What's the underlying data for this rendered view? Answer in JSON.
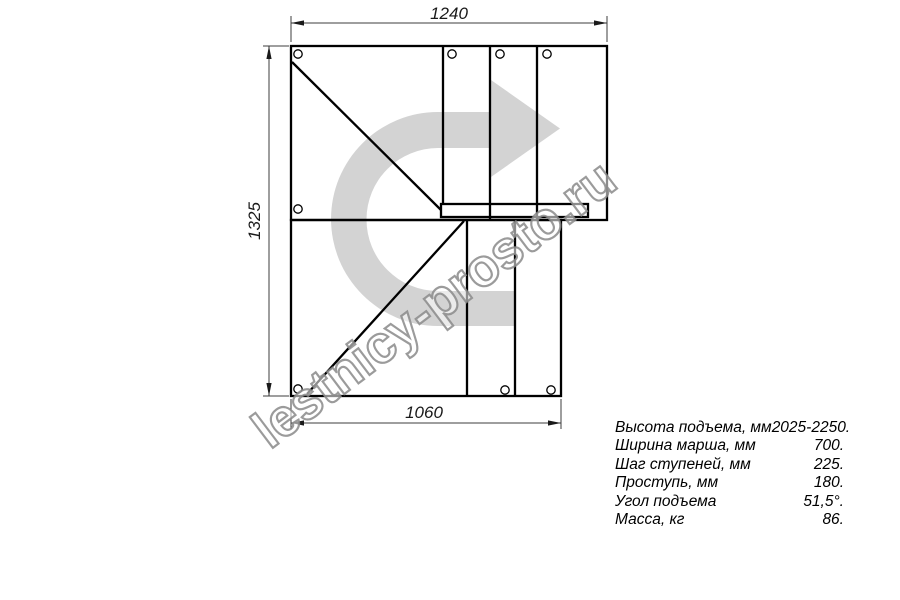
{
  "watermark": {
    "text": "lestnicy-prosto.ru"
  },
  "dimensions": {
    "top_width_mm": "1240",
    "left_height_mm": "1325",
    "bottom_width_mm": "1060"
  },
  "specs": {
    "rows": [
      {
        "label": "Высота подъема, мм",
        "value": "2025-2250."
      },
      {
        "label": "Ширина марша, мм",
        "value": "700."
      },
      {
        "label": "Шаг ступеней, мм",
        "value": "225."
      },
      {
        "label": "Проступь, мм",
        "value": "180."
      },
      {
        "label": "Угол подъема",
        "value": "51,5°."
      },
      {
        "label": "Масса, кг",
        "value": "86."
      }
    ]
  },
  "colors": {
    "line": "#000000",
    "dim_line": "#3c3c3c",
    "arrow_fill": "#d3d3d3",
    "watermark_stroke": "#8a8a8a"
  },
  "icons": {
    "direction_arrow": "u-turn-right-direction-arrow",
    "holes": "mounting-hole-circles"
  }
}
